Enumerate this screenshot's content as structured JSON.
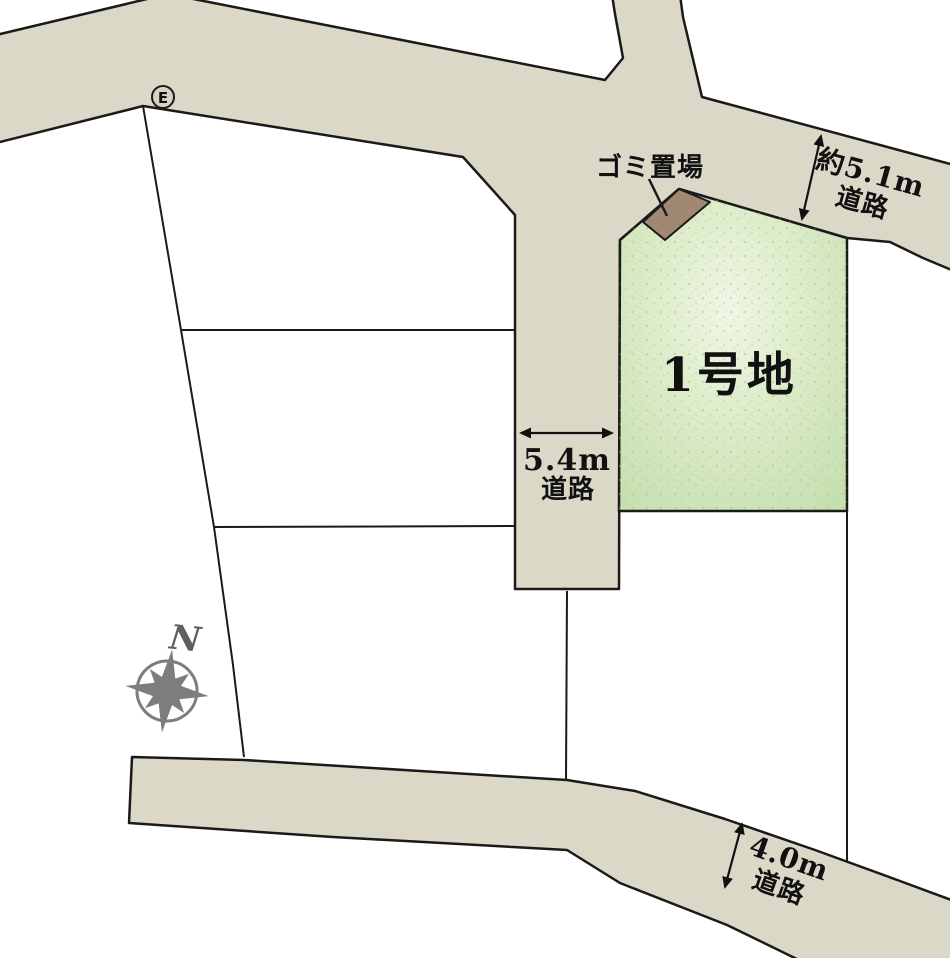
{
  "labels": {
    "lot": "1号地",
    "garbage": "ゴミ置場",
    "road_right_width": "約5.1m",
    "road_right_name": "道路",
    "road_center_width": "5.4m",
    "road_center_name": "道路",
    "road_bottom_width": "4.0m",
    "road_bottom_name": "道路",
    "compass_north": "N",
    "marker_e": "E"
  },
  "colors": {
    "road_fill": "#dcd8c8",
    "outline": "#1a1a1a",
    "lot_fill_edge": "#cbe2b6",
    "lot_fill_center": "#f0f6e6",
    "garbage_fill": "#a18873",
    "compass_gray": "#7d7d7d",
    "marker_fill": "#d6d3c6",
    "background": "#ffffff"
  }
}
